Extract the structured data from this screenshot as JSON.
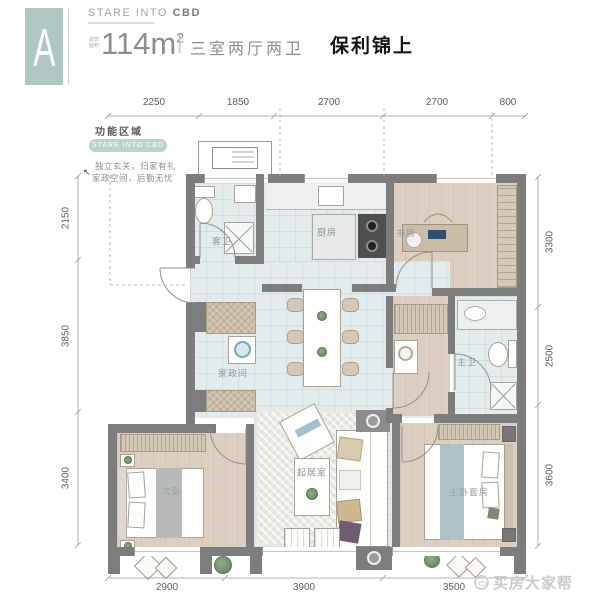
{
  "header": {
    "unit_badge": "A",
    "brand": "STARE INTO",
    "brand_bold": "CBD",
    "area_prefix": "建筑面积",
    "area_value": "114m",
    "area_sup": "2",
    "divider": "|",
    "layout_text": "三室两厅两卫",
    "project_name": "保利锦上"
  },
  "info_panel": {
    "title": "功能区域",
    "pill": "STARE INTO CBD",
    "line1": "独立玄关，归家有礼",
    "line2": "家政空间，后勤无忧",
    "cursor_mark": "↖"
  },
  "dimensions": {
    "top": [
      "2250",
      "1850",
      "2700",
      "2700",
      "800"
    ],
    "left": [
      "2150",
      "3850",
      "3400"
    ],
    "right": [
      "3300",
      "2500",
      "3600"
    ],
    "bottom": [
      "2900",
      "3900",
      "3500"
    ]
  },
  "rooms": {
    "guest_bath": "客卫",
    "kitchen": "厨房",
    "study": "书房",
    "utility": "家政间",
    "master_bath": "主卫",
    "living": "起居室",
    "second_bedroom": "次卧",
    "master_bedroom": "主卧套房"
  },
  "watermark": {
    "text": "买房大家帮"
  },
  "colors": {
    "brand_teal": "#aec7c3",
    "wall_gray": "#7d7d7d",
    "tile_floor": "#e4ebec",
    "wood_floor": "#dccfc1",
    "plant_green": "#7d9a78",
    "title_black": "#151515"
  }
}
